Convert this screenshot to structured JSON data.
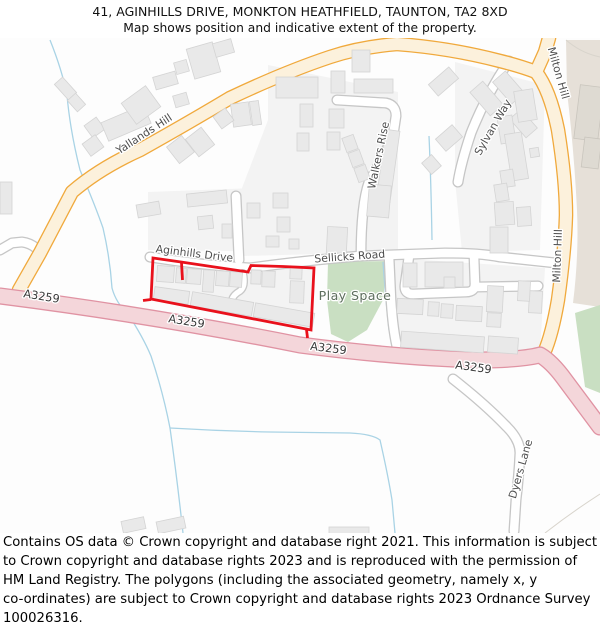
{
  "header": {
    "line1": "41, AGINHILLS DRIVE, MONKTON HEATHFIELD, TAUNTON, TA2 8XD",
    "line2": "Map shows position and indicative extent of the property."
  },
  "footer": {
    "lines": [
      "Contains OS data © Crown copyright and database right 2021. This information is subject",
      "to Crown copyright and database rights 2023 and is reproduced with the permission of",
      "HM Land Registry. The polygons (including the associated geometry, namely x, y",
      "co-ordinates) are subject to Crown copyright and database rights 2023 Ordnance Survey",
      "100026316."
    ]
  },
  "map": {
    "colors": {
      "tint": "#F3F3F3",
      "green": "#C9DFC2",
      "beige": "#E6E0D8",
      "beige_building": "#DEDAD2",
      "beige_building_stroke": "#C9C5BD",
      "stream": "#A9D3E5",
      "faint": "#D8D4CC",
      "building": "#E9E9E9",
      "building_stroke": "#D4D4D4",
      "red": "#E9111C"
    },
    "tints": [
      "153,260 313,269 310,329 152,298",
      "148,192 310,186 308,252 148,250",
      "268,65 398,92 398,252 242,256 242,188 268,120",
      "455,62 545,85 540,250 462,252 455,180",
      "393,258 545,268 540,352 397,352"
    ],
    "greens": [
      "328,262 387,261 383,300 367,330 348,342 331,334 327,300",
      "575,313 600,305 600,393 585,387"
    ],
    "beige": {
      "path": "M566,40 L600,40 L600,307 L573,303 Q579,255 577,210 Q574,150 567,92 Z",
      "buildings": [
        [
          577,
          86,
          24,
          54,
          7
        ],
        [
          583,
          138,
          17,
          30,
          7
        ]
      ]
    },
    "streams": [
      "M50,40 Q62,70 67,95 Q70,130 80,170 Q95,205 103,228 Q110,258 112,288 Q116,303 128,314 Q143,337 151,356 Q163,392 170,428 Q177,478 183,533",
      "M170,428 Q220,431 270,432 L350,433 Q372,434 380,440 Q388,475 392,500 L395,533",
      "M429,136 Q431,180 432,240",
      "M383,262 Q385,292 389,330"
    ],
    "faint_lines": [
      "M566,40 Q580,52 596,56 L600,57",
      "M545,533 Q572,512 600,494"
    ],
    "roads": {
      "lane": {
        "casing": "#C8C8C8",
        "fill": "#FFFFFF",
        "width": 5.5,
        "paths": [
          "M243,273 Q246,286 240,291 Q233,295 232,300"
        ]
      },
      "minor": {
        "casing": "#C6C6C6",
        "fill": "#FFFFFF",
        "width": 8.5,
        "paths": [
          "M150,257 Q200,265 250,268 Q300,261 360,256 L445,253 Q480,253 500,257 L556,263",
          "M0,250 L12,243 L22,242 Q30,243 36,248",
          "M239,260 L236,196",
          "M337,100 L386,103 Q396,105 396,116 L393,136 Q383,158 369,182 Q361,205 361,256",
          "M509,61 Q486,95 471,133 Q461,163 458,182",
          "M389,256 L391,300 Q393,332 398,351",
          "M409,256 L405,285 Q404,294 413,294 L466,292 Q475,292 475,284 L474,256",
          "M475,287 L538,286",
          "M453,379 Q485,404 507,427 Q520,440 520,453 Q519,475 516,500 L514,531"
        ]
      },
      "primary": {
        "casing": "#F0A93C",
        "fill": "#FCF1DC",
        "width": 12,
        "paths": [
          "M19,290 L40,253 L72,192 Q100,168 140,150 Q190,122 230,98 Q285,72 330,57 Q360,47 397,44 Q450,48 500,61 Q520,66 536,72",
          "M536,72 L545,52 L549,38",
          "M536,72 Q550,90 558,130 Q566,180 566,215 Q565,250 558,300 Q552,335 544,353"
        ]
      },
      "aroad": {
        "casing": "#E093A3",
        "fill": "#F4D6DA",
        "width": 14.5,
        "paths": [
          "M0,296 Q150,315 300,345 Q400,358 480,360 Q520,360 540,355 Q552,362 565,380 Q582,403 600,427"
        ]
      }
    },
    "buildings": [
      [
        60,
        78,
        11,
        21,
        -42
      ],
      [
        71,
        95,
        11,
        15,
        -42
      ],
      [
        87,
        120,
        15,
        15,
        -36
      ],
      [
        85,
        138,
        16,
        15,
        -36
      ],
      [
        103,
        113,
        46,
        20,
        -23
      ],
      [
        126,
        92,
        30,
        26,
        -36
      ],
      [
        0,
        182,
        12,
        32,
        0
      ],
      [
        190,
        45,
        27,
        31,
        -16
      ],
      [
        214,
        41,
        19,
        14,
        -16
      ],
      [
        175,
        61,
        13,
        12,
        -16
      ],
      [
        154,
        74,
        23,
        13,
        -16
      ],
      [
        174,
        94,
        14,
        12,
        -16
      ],
      [
        232,
        103,
        18,
        23,
        -8
      ],
      [
        251,
        101,
        9,
        24,
        -8
      ],
      [
        216,
        111,
        15,
        15,
        -36
      ],
      [
        171,
        139,
        19,
        21,
        -38
      ],
      [
        190,
        131,
        20,
        22,
        -38
      ],
      [
        276,
        77,
        42,
        21,
        0
      ],
      [
        331,
        71,
        14,
        22,
        0
      ],
      [
        354,
        79,
        39,
        14,
        0
      ],
      [
        352,
        50,
        18,
        22,
        0
      ],
      [
        300,
        104,
        13,
        23,
        0
      ],
      [
        329,
        109,
        15,
        19,
        0
      ],
      [
        327,
        132,
        13,
        18,
        0
      ],
      [
        297,
        133,
        12,
        18,
        0
      ],
      [
        344,
        136,
        12,
        15,
        -20
      ],
      [
        350,
        151,
        12,
        15,
        -20
      ],
      [
        356,
        166,
        12,
        15,
        -20
      ],
      [
        381,
        130,
        14,
        72,
        8
      ],
      [
        368,
        185,
        22,
        32,
        5
      ],
      [
        327,
        227,
        20,
        26,
        3
      ],
      [
        137,
        203,
        23,
        13,
        -10
      ],
      [
        187,
        192,
        40,
        13,
        -6
      ],
      [
        198,
        216,
        15,
        13,
        -6
      ],
      [
        247,
        203,
        13,
        15,
        0
      ],
      [
        273,
        193,
        15,
        15,
        0
      ],
      [
        277,
        217,
        13,
        15,
        0
      ],
      [
        266,
        236,
        13,
        11,
        0
      ],
      [
        289,
        239,
        10,
        10,
        0
      ],
      [
        222,
        224,
        10,
        14,
        0
      ],
      [
        430,
        74,
        27,
        15,
        -41
      ],
      [
        438,
        130,
        22,
        16,
        -41
      ],
      [
        425,
        157,
        13,
        15,
        -41
      ],
      [
        478,
        83,
        17,
        31,
        -41
      ],
      [
        500,
        73,
        17,
        29,
        -41
      ],
      [
        516,
        111,
        15,
        25,
        -41
      ],
      [
        516,
        90,
        19,
        31,
        -9
      ],
      [
        499,
        116,
        15,
        27,
        -9
      ],
      [
        508,
        133,
        17,
        47,
        -9
      ],
      [
        501,
        170,
        13,
        17,
        -9
      ],
      [
        495,
        184,
        13,
        17,
        -9
      ],
      [
        530,
        148,
        9,
        9,
        -9
      ],
      [
        495,
        202,
        19,
        23,
        -4
      ],
      [
        517,
        207,
        14,
        19,
        -4
      ],
      [
        490,
        227,
        18,
        26,
        0
      ],
      [
        425,
        262,
        38,
        25,
        0
      ],
      [
        403,
        263,
        14,
        24,
        0
      ],
      [
        444,
        277,
        11,
        11,
        0
      ],
      [
        397,
        299,
        26,
        15,
        3
      ],
      [
        428,
        302,
        11,
        14,
        3
      ],
      [
        441,
        304,
        12,
        14,
        3
      ],
      [
        456,
        306,
        26,
        15,
        3
      ],
      [
        487,
        286,
        16,
        26,
        3
      ],
      [
        487,
        313,
        14,
        14,
        3
      ],
      [
        529,
        291,
        13,
        22,
        3
      ],
      [
        518,
        281,
        12,
        20,
        3
      ],
      [
        401,
        334,
        83,
        16,
        4
      ],
      [
        488,
        337,
        30,
        16,
        4
      ],
      [
        157,
        266,
        17,
        16,
        4
      ],
      [
        176,
        268,
        10,
        15,
        4
      ],
      [
        187,
        269,
        14,
        15,
        4
      ],
      [
        203,
        270,
        11,
        22,
        4
      ],
      [
        216,
        271,
        13,
        15,
        4
      ],
      [
        230,
        272,
        12,
        15,
        4
      ],
      [
        251,
        270,
        10,
        14,
        2
      ],
      [
        262,
        271,
        13,
        16,
        2
      ],
      [
        290,
        266,
        12,
        13,
        2
      ],
      [
        290,
        281,
        14,
        22,
        2
      ],
      [
        154,
        289,
        35,
        13,
        8
      ],
      [
        191,
        297,
        62,
        14,
        10
      ],
      [
        254,
        308,
        60,
        14,
        10
      ],
      [
        122,
        519,
        23,
        12,
        -12
      ],
      [
        157,
        519,
        28,
        12,
        -12
      ],
      [
        329,
        527,
        40,
        8,
        0
      ]
    ],
    "red_polygon": {
      "points": "153,258 181,262 248,272 251,265.5 283,266.5 314,268 311,330 151,299",
      "ticks": [
        "M181.5,262.5 L182.5,280",
        "M151,299.5 L143,300.5",
        "M306.5,329.5 L307.5,338"
      ]
    },
    "labels": [
      {
        "t": "Yallands Hill",
        "x": 146,
        "y": 137,
        "r": -33,
        "cls": "road"
      },
      {
        "t": "Aginhills Drive",
        "x": 194,
        "y": 257,
        "r": 7,
        "cls": "road"
      },
      {
        "t": "Sellicks Road",
        "x": 350,
        "y": 260,
        "r": -4,
        "cls": "road"
      },
      {
        "t": "Walkers Rise",
        "x": 382,
        "y": 156,
        "r": -78,
        "cls": "road"
      },
      {
        "t": "Sylvan Way",
        "x": 496,
        "y": 129,
        "r": -60,
        "cls": "road"
      },
      {
        "t": "Milton Hill",
        "x": 555,
        "y": 74,
        "r": 74,
        "cls": "road"
      },
      {
        "t": "Milton Hill",
        "x": 561,
        "y": 256,
        "r": -88,
        "cls": "road"
      },
      {
        "t": "Dyers Lane",
        "x": 524,
        "y": 470,
        "r": -74,
        "cls": "road"
      },
      {
        "t": "Play Space",
        "x": 355,
        "y": 300,
        "r": 0,
        "cls": "area"
      },
      {
        "t": "A3259",
        "x": 41,
        "y": 300,
        "r": 9,
        "cls": "aroad"
      },
      {
        "t": "A3259",
        "x": 186,
        "y": 325,
        "r": 9,
        "cls": "aroad"
      },
      {
        "t": "A3259",
        "x": 328,
        "y": 352,
        "r": 7,
        "cls": "aroad"
      },
      {
        "t": "A3259",
        "x": 473,
        "y": 371,
        "r": 8,
        "cls": "aroad"
      }
    ]
  }
}
